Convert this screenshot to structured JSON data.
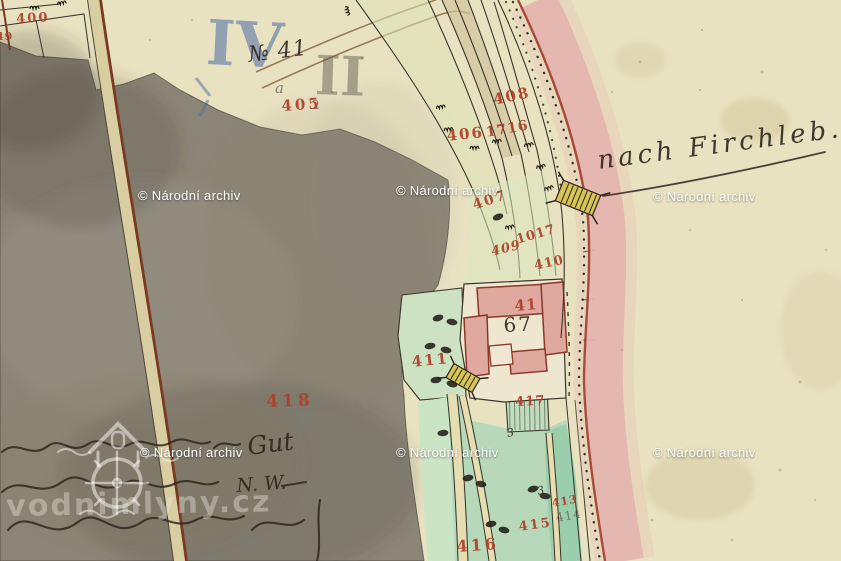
{
  "watermarks": {
    "archive": "© Národní archiv",
    "mill_logo_text": "vodnimlyny.cz"
  },
  "road": {
    "destination_label": "nach Firchleb."
  },
  "notes": {
    "section_blue": "IV",
    "section_pencil": "II",
    "house_note": "№ 41",
    "pencil_letter": "a",
    "pencil_digit": "2",
    "meadow_mark": "3",
    "handwriting_word_gut": "Gut",
    "handwriting_word_nw": "N. W."
  },
  "parcels": {
    "p400": "400",
    "p49": "49",
    "p405": "405",
    "p406": "406",
    "p407": "407",
    "p408": "408",
    "p409": "409",
    "p410": "410",
    "p411": "411",
    "p413": "413",
    "p414": "414",
    "p415": "415",
    "p416": "416",
    "p417": "417",
    "p418": "418",
    "p1017": "1017",
    "p1716": "1716"
  },
  "farm": {
    "house_number_red": "41",
    "house_number_black": "67"
  },
  "colors": {
    "paper": "#e9e2c1",
    "field_gray": "#8b8577",
    "meadow_green": "#b7d9ba",
    "road_pink": "#e3b5af",
    "building_pink": "#dfa9a0",
    "number_red": "#ad3f2a",
    "pencil_blue": "#4f7ab0"
  }
}
